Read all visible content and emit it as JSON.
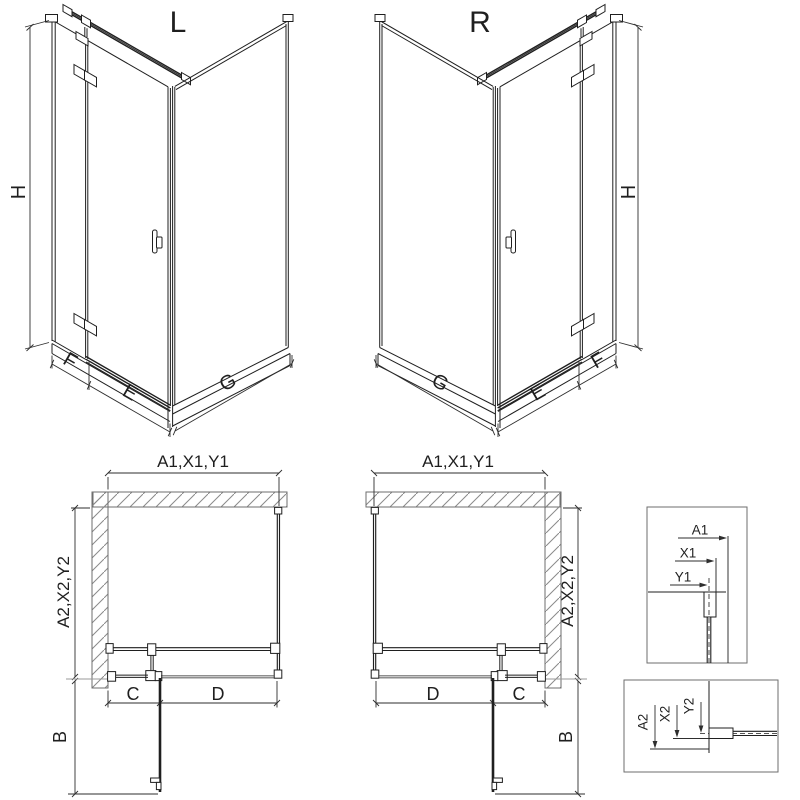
{
  "diagram": {
    "subject": "Corner shower enclosure technical dimension drawing, left (L) and right (R) door versions"
  },
  "views": {
    "iso_left": {
      "title": "L",
      "dim_height": "H",
      "dim_fixed": "F",
      "dim_door": "E",
      "dim_side": "G"
    },
    "iso_right": {
      "title": "R",
      "dim_height": "H",
      "dim_fixed": "F",
      "dim_door": "E",
      "dim_side": "G"
    },
    "plan_left": {
      "dim_width": "A1,X1,Y1",
      "dim_depth": "A2,X2,Y2",
      "dim_fixed": "C",
      "dim_door": "D",
      "dim_swing": "B"
    },
    "plan_right": {
      "dim_width": "A1,X1,Y1",
      "dim_depth": "A2,X2,Y2",
      "dim_fixed": "C",
      "dim_door": "D",
      "dim_swing": "B"
    },
    "detail_width": {
      "dims": [
        "A1",
        "X1",
        "Y1"
      ]
    },
    "detail_depth": {
      "dims": [
        "A2",
        "X2",
        "Y2"
      ]
    }
  },
  "colors": {
    "line": "#1f1f1f",
    "dimension": "#2e2e2e",
    "wall_outline": "#6e6e6e",
    "hatch": "#8a8a8a",
    "extension_gray": "#9a9a9a",
    "background": "#ffffff"
  }
}
